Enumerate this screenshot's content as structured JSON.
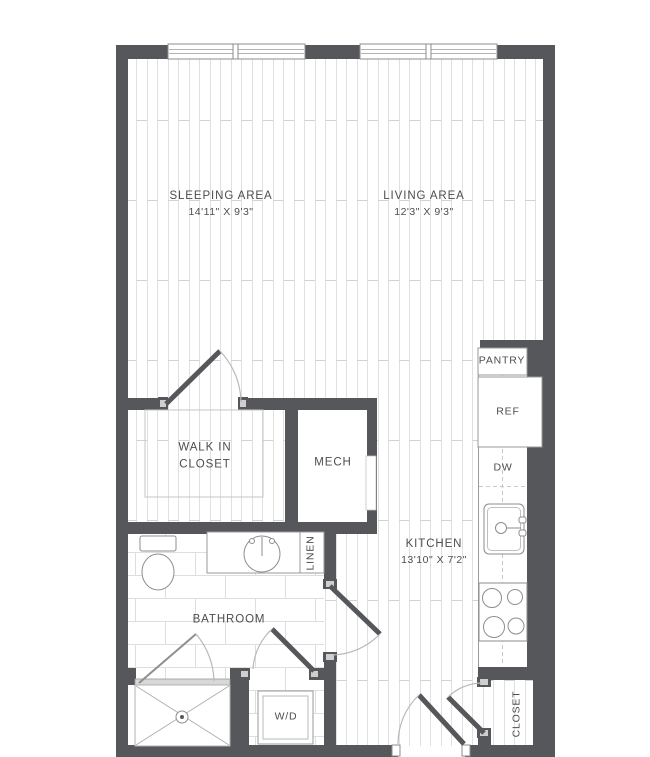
{
  "floorplan": {
    "title": "Studio apartment floor plan",
    "colors": {
      "wall": "#55575a",
      "text": "#4c4d4f",
      "fixture_line": "#8c8c8c",
      "floor_line": "#e0e0e0"
    },
    "rooms": {
      "sleeping_area": {
        "name": "SLEEPING AREA",
        "dimensions": "14'11\" X 9'3\""
      },
      "living_area": {
        "name": "LIVING AREA",
        "dimensions": "12'3\" X 9'3\""
      },
      "kitchen": {
        "name": "KITCHEN",
        "dimensions": "13'10\" X 7'2\""
      },
      "walk_in_closet": {
        "name_line1": "WALK IN",
        "name_line2": "CLOSET"
      },
      "mech": {
        "name": "MECH"
      },
      "bathroom": {
        "name": "BATHROOM"
      },
      "linen": {
        "name": "LINEN"
      },
      "pantry": {
        "name": "PANTRY"
      },
      "ref": {
        "name": "REF"
      },
      "dw": {
        "name": "DW"
      },
      "wd": {
        "name": "W/D"
      },
      "closet": {
        "name": "CLOSET"
      }
    }
  }
}
